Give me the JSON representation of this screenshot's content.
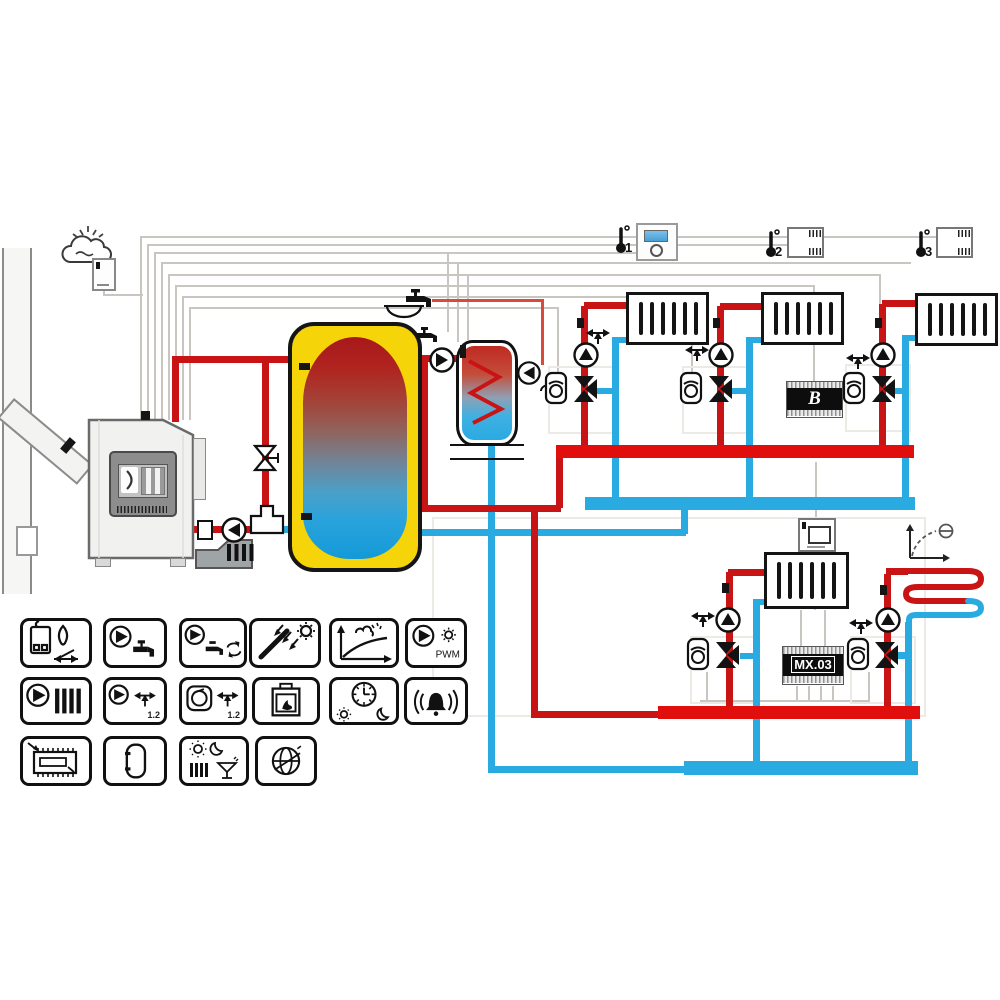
{
  "title": "Heating system hydraulic scheme",
  "labels": {
    "module_b": "B",
    "module_mx": "MX.03",
    "pwm": "PWM",
    "mixer_count_a": "1.2",
    "mixer_count_b": "1.2"
  },
  "thermostats": [
    {
      "id": "1"
    },
    {
      "id": "2"
    },
    {
      "id": "3"
    }
  ],
  "colors": {
    "supply_red": "#c81414",
    "return_cyan": "#29abe2",
    "manifold_red": "#e10e0e",
    "buffer_yellow": "#f6d40a",
    "module_black": "#0d0d0d"
  },
  "components": [
    "solid-fuel-boiler",
    "boiler-controller",
    "outdoor-sensor",
    "chimney",
    "buffer-tank",
    "dhw-tank",
    "dhw-circulation",
    "radiator-circuit-1",
    "radiator-circuit-2",
    "radiator-circuit-3",
    "radiator-circuit-4",
    "floor-heating-circuit",
    "module-b",
    "module-mx03",
    "room-thermostat-1",
    "room-thermostat-2",
    "room-thermostat-3",
    "room-panel",
    "heating-curve"
  ],
  "legend_icons": [
    {
      "name": "boiler-flame-control"
    },
    {
      "name": "dhw-pump-tap"
    },
    {
      "name": "dhw-circulation-pump"
    },
    {
      "name": "solar-collector"
    },
    {
      "name": "weather-heating-curve"
    },
    {
      "name": "pwm-pump",
      "label": "PWM"
    },
    {
      "name": "heating-circuit-pump"
    },
    {
      "name": "mixer-pump",
      "label": "1.2"
    },
    {
      "name": "mixer-actuator",
      "label": "1.2"
    },
    {
      "name": "fuel-feeder-boiler"
    },
    {
      "name": "time-programs-day-night"
    },
    {
      "name": "alarm"
    },
    {
      "name": "expansion-module"
    },
    {
      "name": "buffer-tank"
    },
    {
      "name": "work-modes"
    },
    {
      "name": "internet-module"
    }
  ]
}
